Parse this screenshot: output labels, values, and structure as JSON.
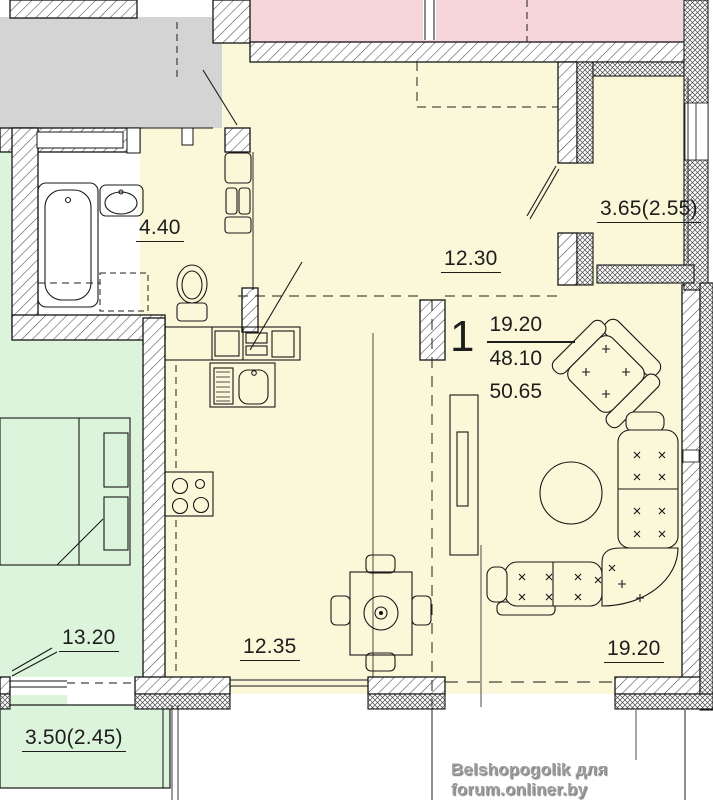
{
  "apartment": {
    "number": "1",
    "areas": {
      "living": "19.20",
      "apartment": "48.10",
      "total": "50.65"
    }
  },
  "room_labels": {
    "hall": "4.40",
    "bedroom": "12.30",
    "balcony_right": "3.65(2.55)",
    "room_left": "13.20",
    "kitchen_dining": "12.35",
    "living": "19.20",
    "balcony_bottom": "3.50(2.45)"
  },
  "watermark": "Belshopogolik для forum.onliner.by",
  "colors": {
    "floor_cream": "#fbf8da",
    "neighbor_pink": "#f6d6da",
    "neighbor_green": "#dcf3dc",
    "stair_gray": "#d4d4d4",
    "line": "#1a1a1a",
    "watermark": "#9b9b9b"
  }
}
